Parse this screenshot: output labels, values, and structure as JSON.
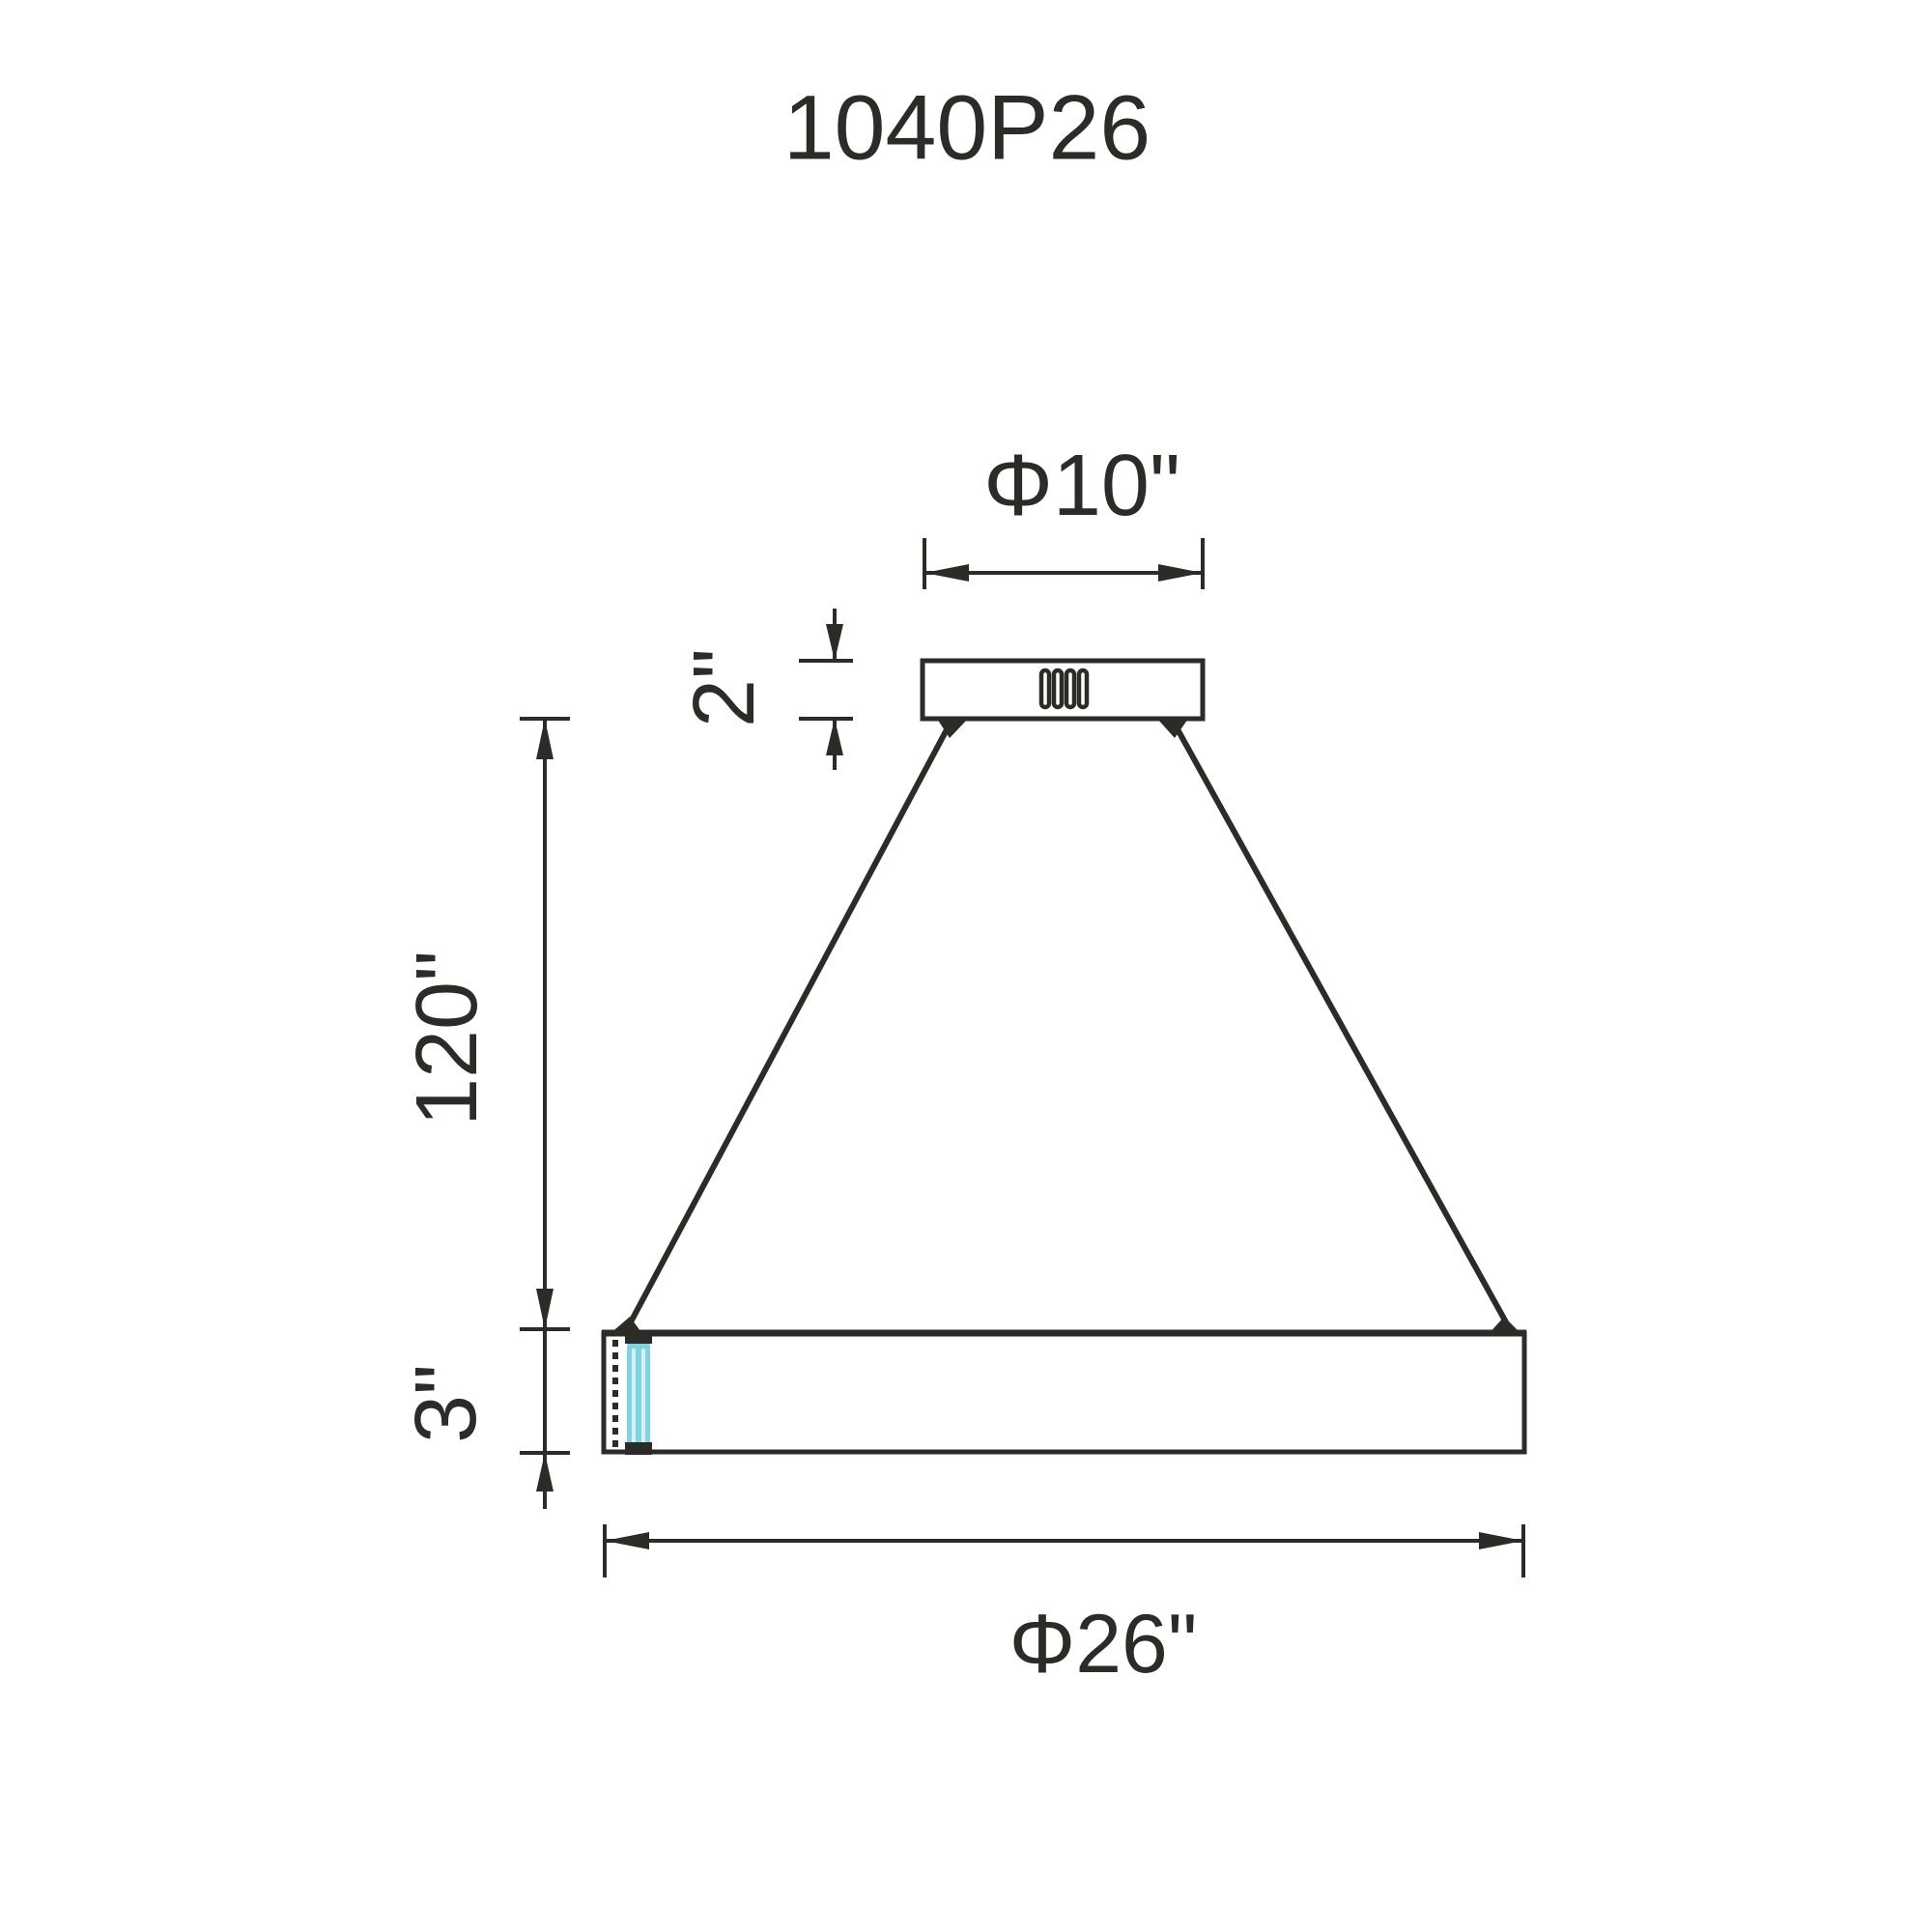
{
  "title": "1040P26",
  "labels": {
    "canopy_diameter": "Φ10\"",
    "canopy_height": "2\"",
    "suspension_length": "120\"",
    "ring_height": "3\"",
    "ring_diameter": "Φ26\""
  },
  "colors": {
    "line": "#2b2b28",
    "led_accent": "#7fd4e2",
    "led_highlight": "#d6f1f5",
    "background": "#ffffff"
  }
}
